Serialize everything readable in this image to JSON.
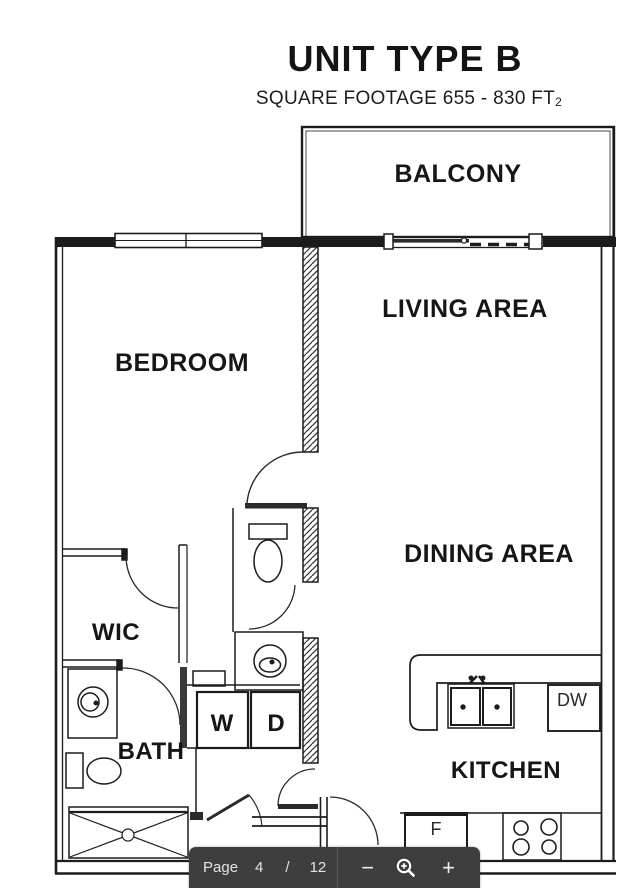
{
  "header": {
    "title": "UNIT TYPE B",
    "subtitle": "SQUARE FOOTAGE 655 - 830 FT",
    "subtitle_subscript": "2"
  },
  "floorplan": {
    "labels": {
      "balcony": "BALCONY",
      "living": "LIVING AREA",
      "dining": "DINING AREA",
      "bedroom": "BEDROOM",
      "wic": "WIC",
      "bath": "BATH",
      "kitchen": "KITCHEN",
      "washer": "W",
      "dryer": "D",
      "dishwasher": "DW",
      "fridge": "F"
    }
  },
  "toolbar": {
    "page_label": "Page",
    "current_page": "4",
    "page_separator": "/",
    "total_pages": "12",
    "zoom_out_label": "−",
    "zoom_in_label": "+"
  },
  "colors": {
    "line": "#1c1c1c",
    "toolbar_bg": "#3e3e3e",
    "toolbar_text": "#e4e4e4"
  }
}
